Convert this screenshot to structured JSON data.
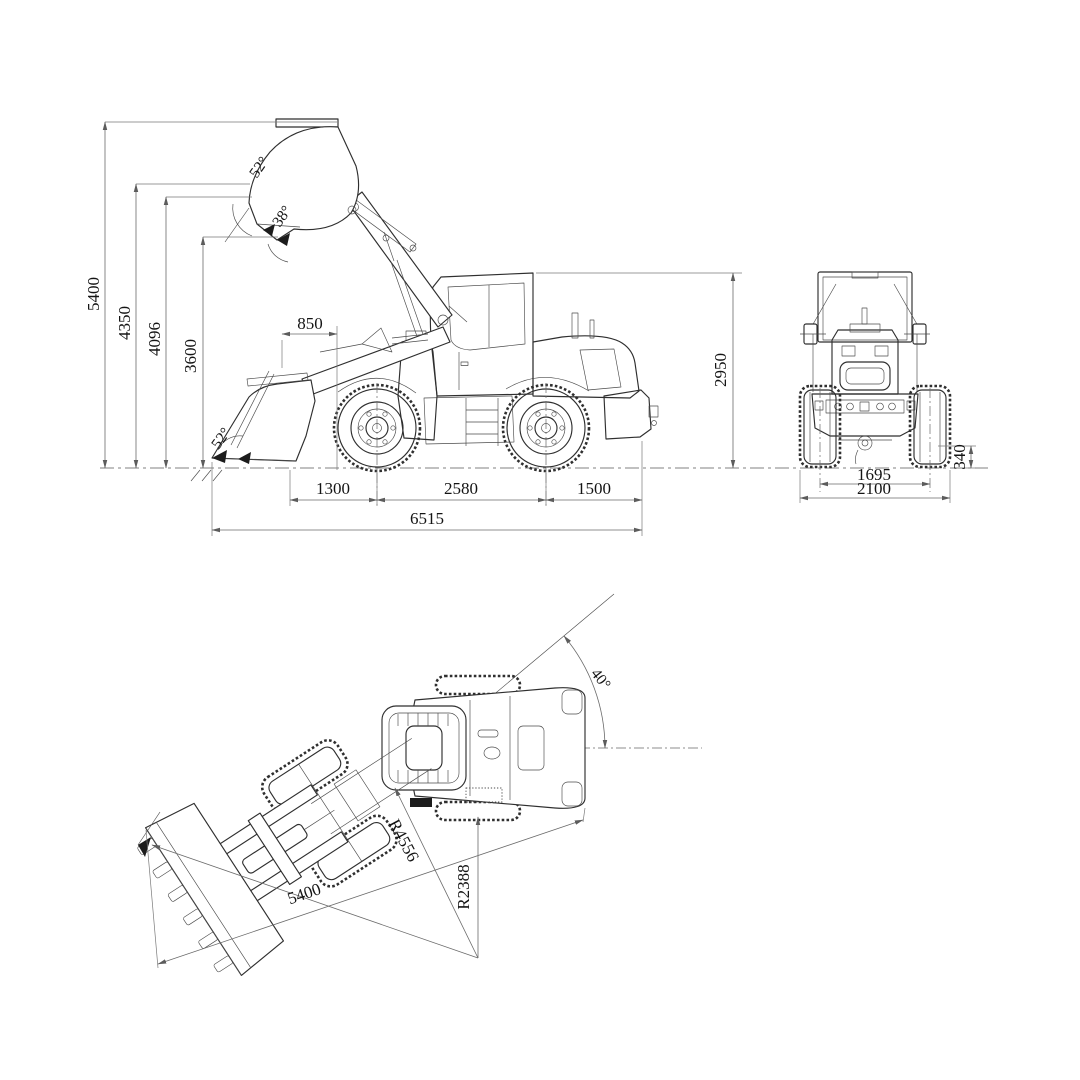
{
  "drawing": {
    "kind": "wheel-loader-dimensional-three-view",
    "background": "#ffffff",
    "line_color": "#2f2f2f",
    "dimension_color": "#6a6a6a"
  },
  "views": {
    "side": {
      "name": "side-elevation",
      "dims": {
        "max_lift_height": "5400",
        "dump_clearance_height": "4350",
        "hinge_pin_height": "4096",
        "dump_height": "3600",
        "dump_reach": "850",
        "dump_angle": "52°",
        "rollback_angle": "38°",
        "digging_angle": "52°",
        "front_overhang": "1300",
        "wheelbase": "2580",
        "rear_overhang": "1500",
        "overall_length": "6515",
        "overall_height": "2950"
      }
    },
    "rear": {
      "name": "rear-elevation",
      "dims": {
        "ground_clearance": "340",
        "track_width": "1695",
        "overall_width": "2100"
      }
    },
    "top": {
      "name": "plan-view-articulated",
      "dims": {
        "articulation_angle": "40°",
        "operating_length": "5400",
        "inner_turning_radius": "R2388",
        "outer_turning_radius": "R4556"
      }
    }
  }
}
